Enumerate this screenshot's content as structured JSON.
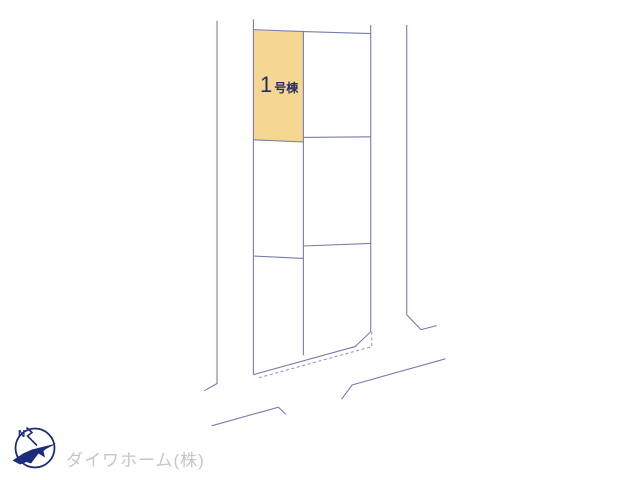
{
  "colors": {
    "line": "#787dac",
    "dash": "#8b90bd",
    "lot_fill": "#f6d693",
    "lot_label": "#262b63",
    "logo": "#1c2b7a",
    "credit": "#c6c6c6",
    "background": "#ffffff"
  },
  "site_plan": {
    "lot1": {
      "number": "1",
      "suffix": "号棟"
    },
    "compass": {
      "label": "N"
    },
    "credit": {
      "company": "ダイワホーム(株)"
    }
  }
}
